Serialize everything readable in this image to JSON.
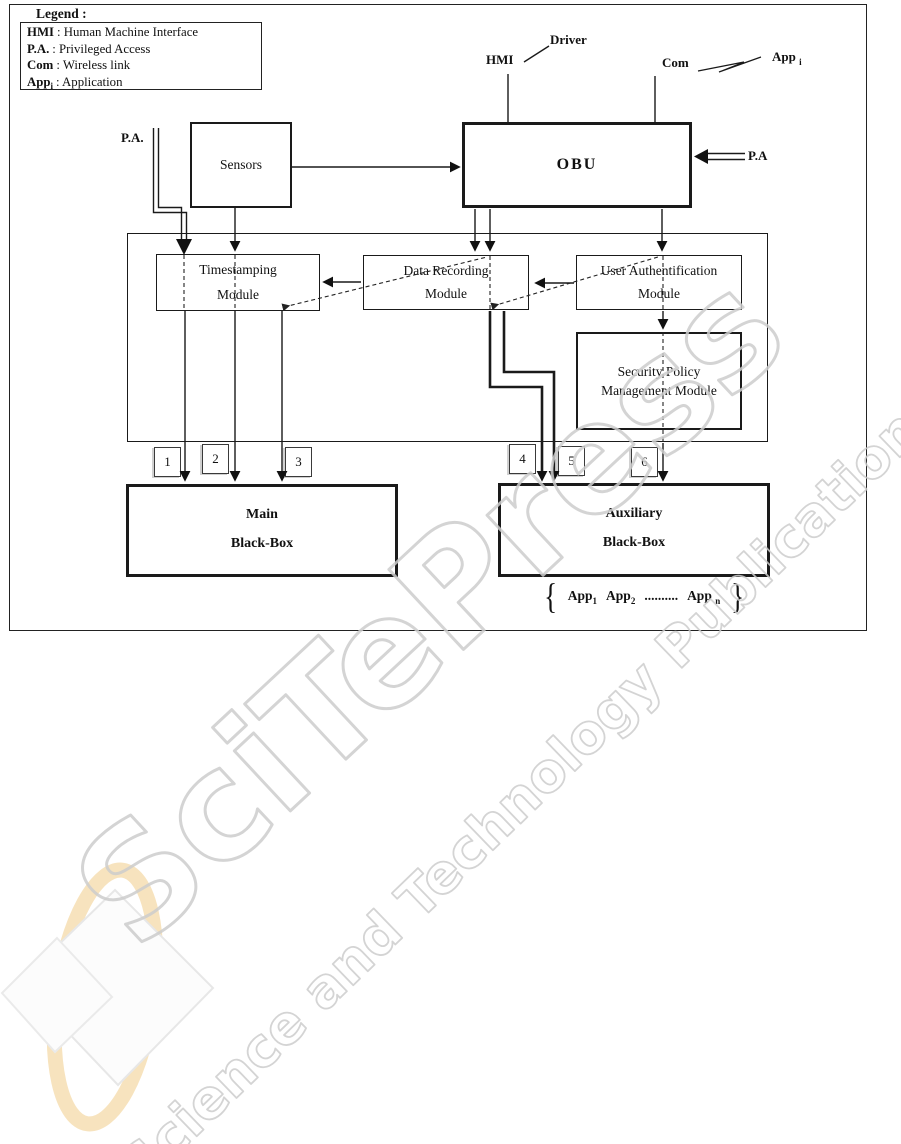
{
  "legend": {
    "title": "Legend :",
    "items": [
      {
        "term": "HMI",
        "sub": "",
        "def": ": Human Machine Interface"
      },
      {
        "term": "P.A.",
        "sub": "",
        "def": ": Privileged Access"
      },
      {
        "term": "Com",
        "sub": "",
        "def": ": Wireless link"
      },
      {
        "term": "App",
        "sub": "i",
        "def": ": Application"
      }
    ]
  },
  "top_labels": {
    "hmi": "HMI",
    "driver": "Driver",
    "com": "Com",
    "app_base": "App",
    "app_sub": "i"
  },
  "side_labels": {
    "pa_left": "P.A.",
    "pa_right": "P.A"
  },
  "boxes": {
    "sensors": "Sensors",
    "obu": "OBU",
    "timestamping": {
      "line1": "Timestamping",
      "line2": "Module"
    },
    "data_recording": {
      "line1": "Data Recording",
      "line2": "Module"
    },
    "user_auth": {
      "line1": "User Authentification",
      "line2": "Module"
    },
    "security_policy": {
      "line1": "Security Policy",
      "line2": "Management Module"
    },
    "main_bb": {
      "line1": "Main",
      "line2": "Black-Box"
    },
    "aux_bb": {
      "line1": "Auxiliary",
      "line2": "Black-Box"
    }
  },
  "connectors": [
    "1",
    "2",
    "3",
    "4",
    "5",
    "6"
  ],
  "app_list": {
    "brace_left": "{",
    "brace_right": "}",
    "items": [
      {
        "base": "App",
        "sub": "1"
      },
      {
        "base": "App",
        "sub": "2"
      }
    ],
    "dots": "..........",
    "last_base": "App",
    "last_sub": "n"
  },
  "watermark": {
    "big": "SciTePress",
    "small": "Science and Technology Publications"
  },
  "colors": {
    "line": "#1a1a1a",
    "watermark_gray": "#cdcdcd",
    "logo_cream": "#f6ddae"
  }
}
